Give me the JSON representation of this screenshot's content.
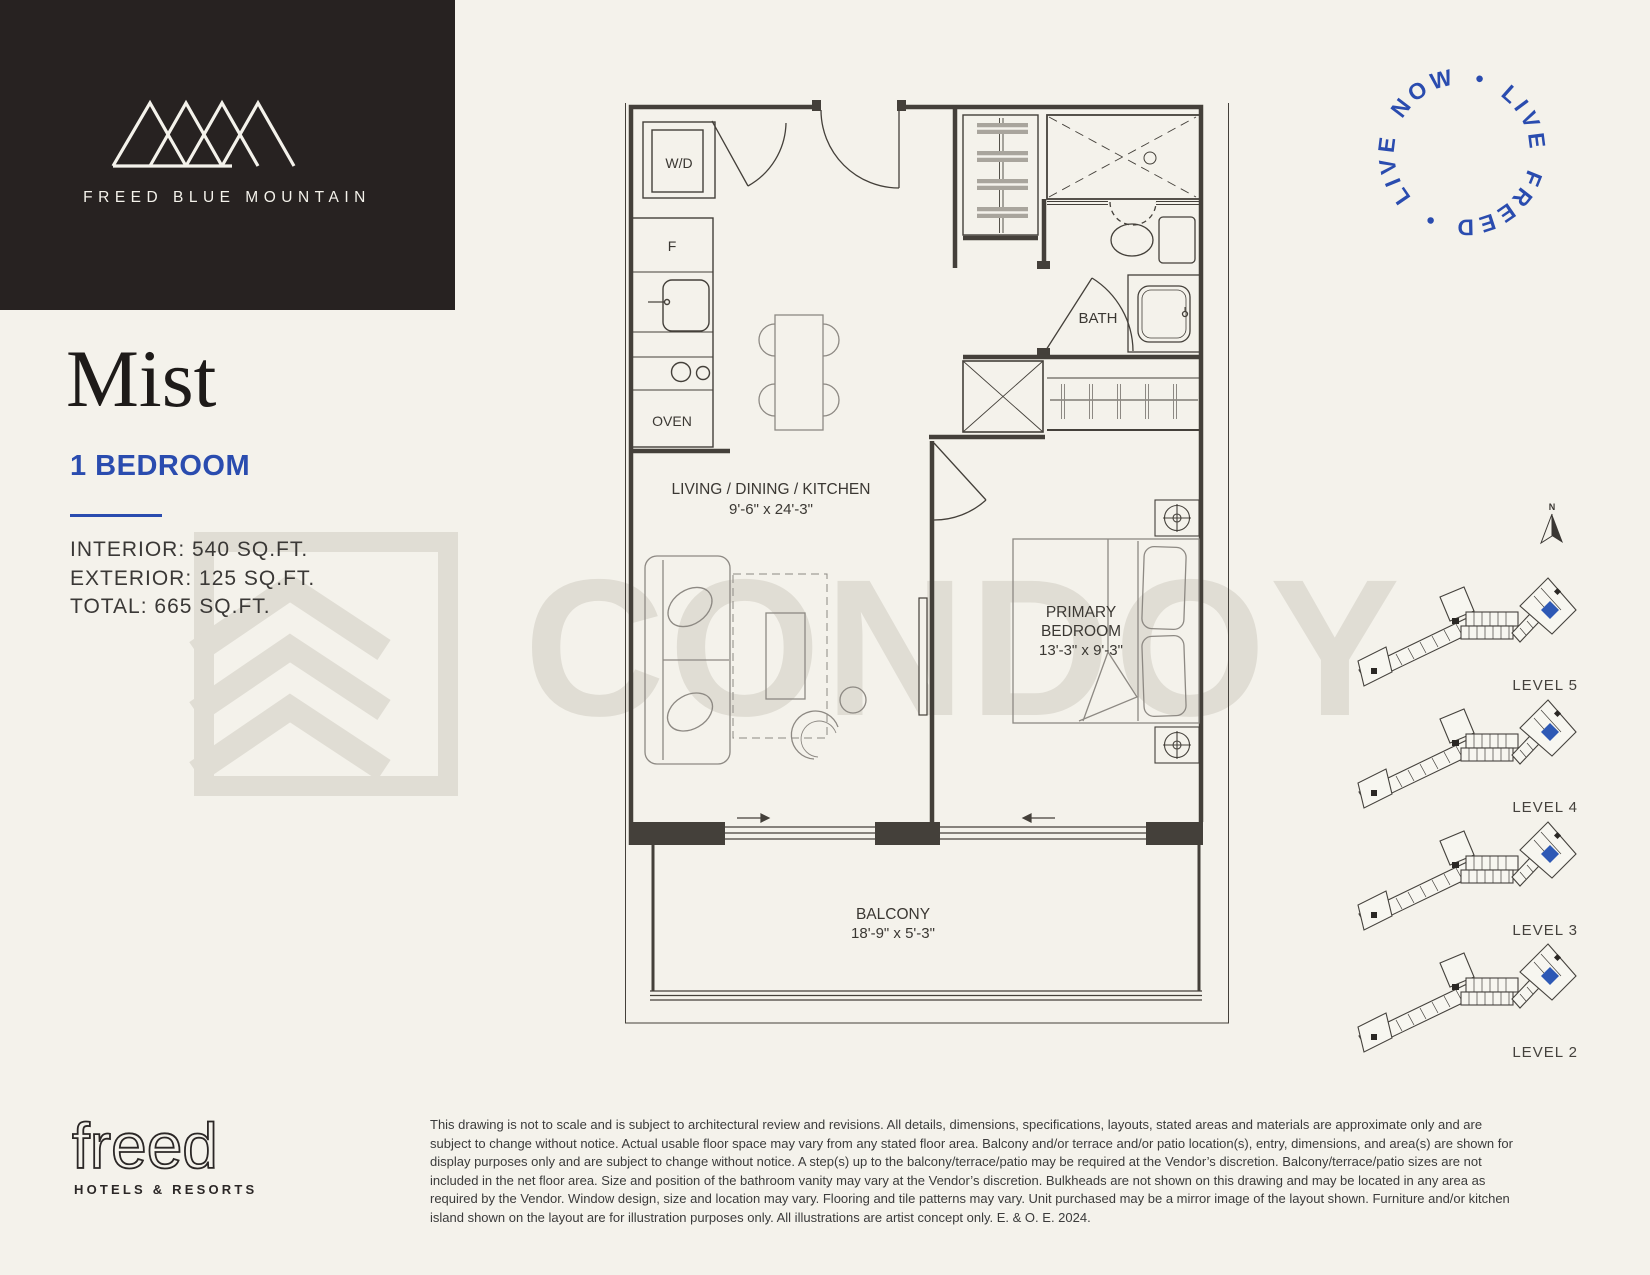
{
  "palette": {
    "background": "#f4f2eb",
    "ink": "#272221",
    "accent_blue": "#2a4caf",
    "plan_line": "#44403a",
    "watermark_gray": "#e0ddd4",
    "keyplan_unit_blue": "#2e59b5"
  },
  "header": {
    "brand": "FREED BLUE MOUNTAIN",
    "logo_icon": "mountain-peaks-icon"
  },
  "badge": {
    "circle_text": "LIVE NOW • LIVE FREED •"
  },
  "unit": {
    "name": "Mist",
    "type": "1 BEDROOM",
    "specs": [
      "INTERIOR: 540 SQ.FT.",
      "EXTERIOR: 125 SQ.FT.",
      "TOTAL: 665 SQ.FT."
    ]
  },
  "floorplan": {
    "rooms": {
      "living": {
        "name": "LIVING / DINING / KITCHEN",
        "dims": "9'-6\" x 24'-3\""
      },
      "bedroom": {
        "name_line1": "PRIMARY",
        "name_line2": "BEDROOM",
        "dims": "13'-3\" x 9'-3\""
      },
      "balcony": {
        "name": "BALCONY",
        "dims": "18'-9\" x 5'-3\""
      },
      "bath": {
        "name": "BATH"
      }
    },
    "appliances": {
      "washer_dryer": "W/D",
      "fridge": "F",
      "oven": "OVEN"
    }
  },
  "keyplan": {
    "north_label": "N",
    "levels": [
      "LEVEL 5",
      "LEVEL 4",
      "LEVEL 3",
      "LEVEL 2"
    ]
  },
  "watermark": {
    "text": "CONDOY"
  },
  "footer": {
    "logo_text": "freed",
    "logo_tagline": "HOTELS & RESORTS",
    "disclaimer": "This drawing is not to scale and is subject to architectural review and revisions. All details, dimensions, specifications, layouts, stated areas and materials are approximate only and are subject to change without notice. Actual usable floor space may vary from any stated floor area. Balcony and/or terrace and/or patio location(s), entry, dimensions, and area(s) are shown for display purposes only and are subject to change without notice. A step(s) up to the balcony/terrace/patio may be required at the Vendor’s discretion. Balcony/terrace/patio sizes are not included in the net floor area. Size and position of the bathroom vanity may vary at the Vendor’s discretion. Bulkheads are not shown on this drawing and may be located in any area as required by the Vendor. Window design, size and location may vary. Flooring and tile patterns may vary. Unit purchased may be a mirror image of the layout shown. Furniture and/or kitchen island shown on the layout are for illustration purposes only. All illustrations are artist concept only. E. & O. E. 2024."
  }
}
